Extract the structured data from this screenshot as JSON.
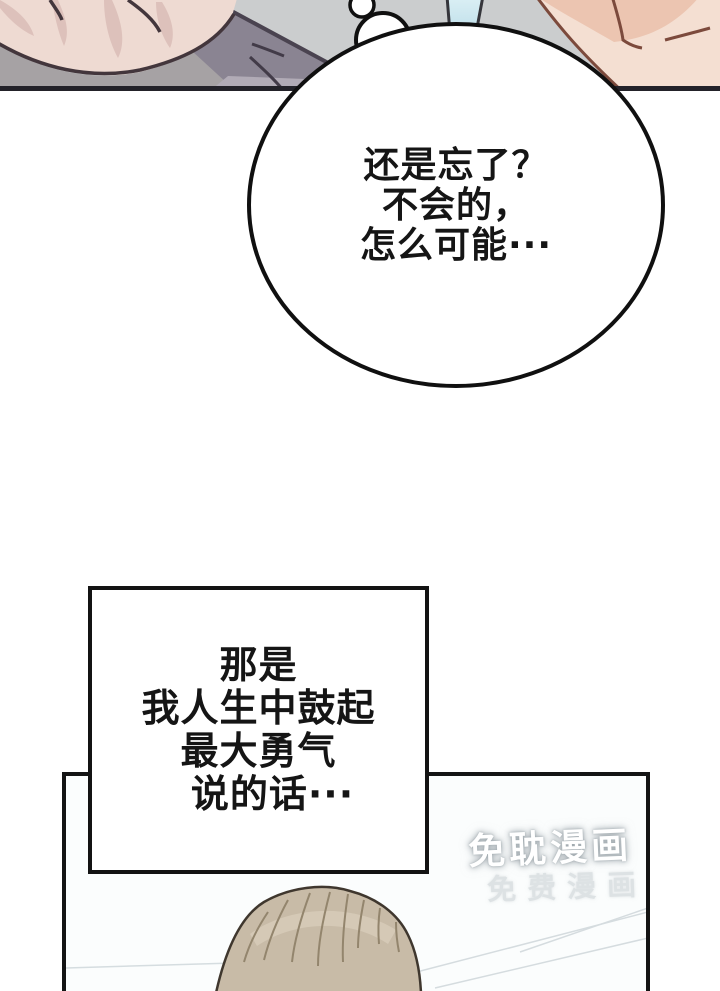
{
  "comic": {
    "speech_bubble": {
      "lines": [
        "还是忘了？",
        "不会的，",
        "怎么可能···"
      ]
    },
    "narration_box": {
      "lines": [
        "那是",
        "我人生中鼓起",
        "最大勇气",
        "说的话···"
      ]
    },
    "watermark": {
      "primary": "免耽漫画",
      "secondary": "免费漫画"
    }
  },
  "colors": {
    "page_bg": "#ffffff",
    "top_panel_bg": "#cbcdce",
    "panel_border": "#232229",
    "bubble_fill": "#ffffff",
    "bubble_outline": "#101010",
    "text": "#151515",
    "skin_light": "#eedad2",
    "skin_warm": "#ecc5b1",
    "clothing_slate": "#8a8492",
    "clothing_gray": "#a6a2a4",
    "blue_accent": "#bfe0ea",
    "hair": "#c8bba7",
    "bottom_panel_fill": "#fbfdfd",
    "watermark_white": "#ffffff",
    "watermark_gray": "#dde2e4"
  }
}
